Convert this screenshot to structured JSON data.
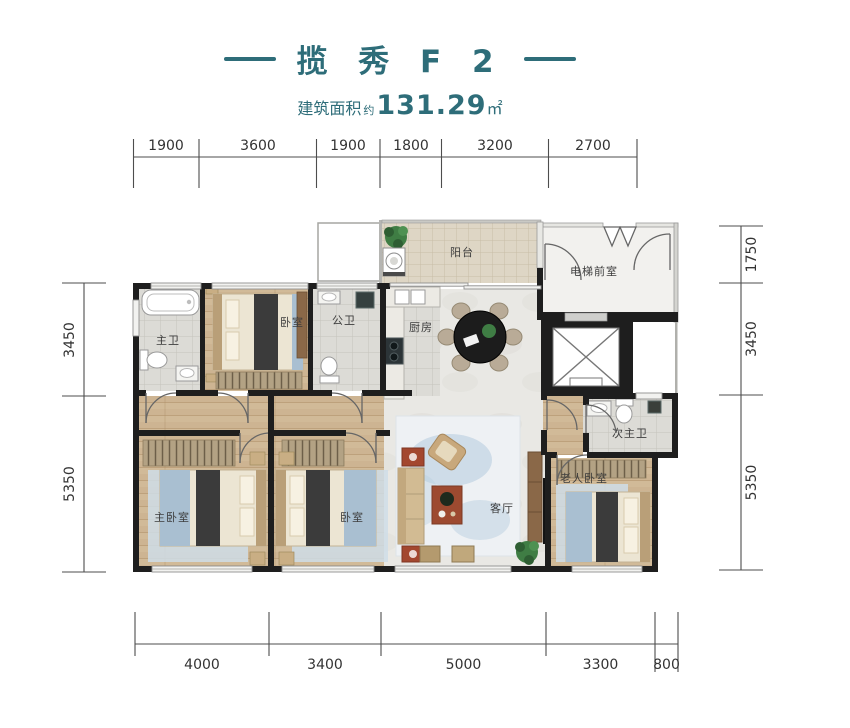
{
  "header": {
    "title": "揽 秀 F 2",
    "area_label": "建筑面积",
    "area_approx": "约",
    "area_value": "131.29",
    "area_unit": "㎡"
  },
  "dims": {
    "top": [
      "1900",
      "3600",
      "1900",
      "1800",
      "3200",
      "2700"
    ],
    "bottom": [
      "4000",
      "3400",
      "5000",
      "3300",
      "800"
    ],
    "left": [
      "3450",
      "5350"
    ],
    "right": [
      "1750",
      "3450",
      "5350"
    ]
  },
  "rooms": {
    "balcony": "阳台",
    "elevator_lobby": "电梯前室",
    "master_bath": "主卫",
    "bedroom_top": "卧室",
    "public_bath": "公卫",
    "kitchen": "厨房",
    "master_bedroom": "主卧室",
    "bedroom_bottom": "卧室",
    "living_room": "客厅",
    "elderly_bedroom": "老人卧室",
    "secondary_bath": "次主卫"
  },
  "colors": {
    "accent": "#2e6d79",
    "wall": "#1e1e1e",
    "dim_line": "#4d4d4d",
    "wood": "#cdb492",
    "tile": "#dcdbd6",
    "marble": "#e9e8e4",
    "balcony_tile": "#ded6c5",
    "rug_blue": "#cfdde8"
  }
}
